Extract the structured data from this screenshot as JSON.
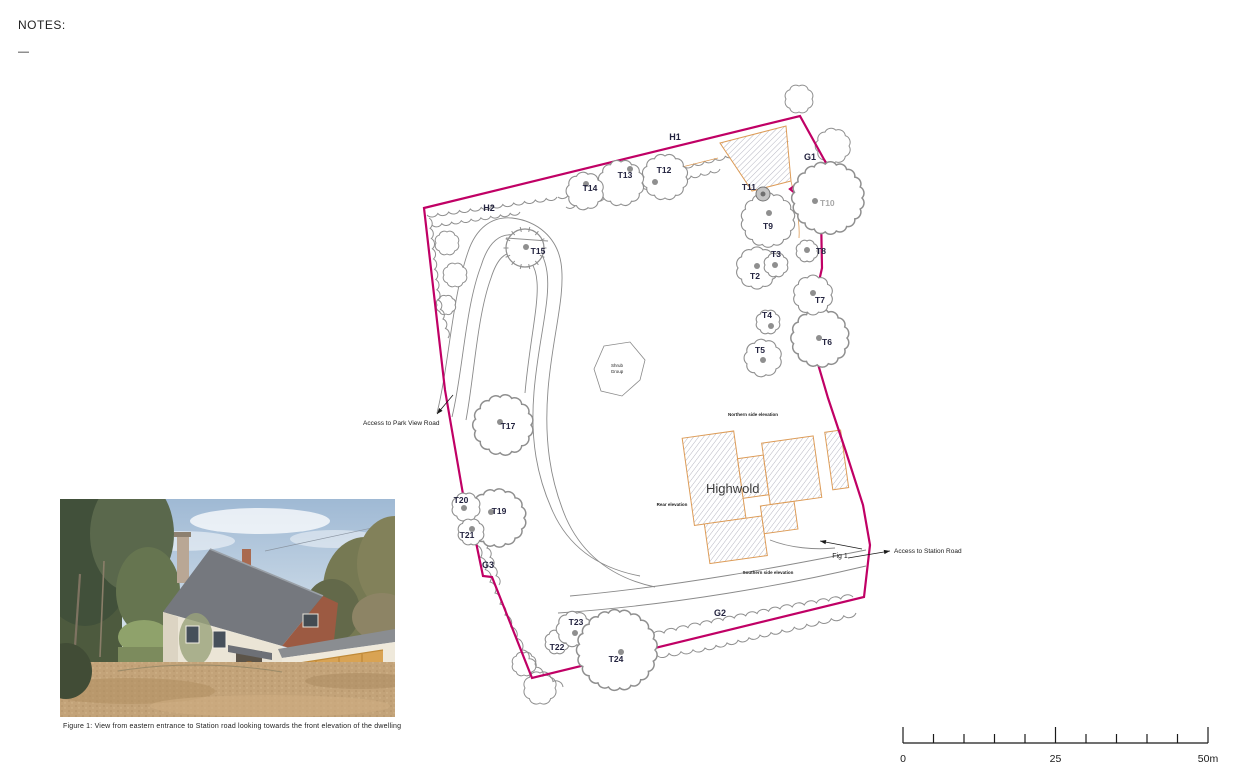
{
  "notes": {
    "title": "NOTES:",
    "dash": "—"
  },
  "figure": {
    "caption": "Figure 1: View from eastern entrance to Station road looking towards the front elevation of the dwelling"
  },
  "scale_bar": {
    "labels": [
      "0",
      "25",
      "50m"
    ],
    "divisions": 10,
    "units_per_division_m": 5
  },
  "colors": {
    "boundary": "#c00065",
    "canopy": "#8f8f8f",
    "dot": "#8f8f8f",
    "label": "#23233f",
    "muted_label": "#a8a8a8",
    "building_outline": "#dd9c58",
    "hatch_line": "#b6b6c2",
    "annotation": "#1a1a1a",
    "drive": "#8a8a8a"
  },
  "plan": {
    "building_name": "Highwold",
    "trees": [
      {
        "id": "T2",
        "cx": 757,
        "cy": 268,
        "r": 19,
        "dx": 757,
        "dy": 266,
        "lx": 755,
        "ly": 279
      },
      {
        "id": "T3",
        "cx": 776,
        "cy": 265,
        "r": 11,
        "dx": 775,
        "dy": 265,
        "lx": 776,
        "ly": 257
      },
      {
        "id": "T4",
        "cx": 768,
        "cy": 322,
        "r": 11,
        "dx": 771,
        "dy": 326,
        "lx": 767,
        "ly": 318
      },
      {
        "id": "T5",
        "cx": 763,
        "cy": 358,
        "r": 17,
        "dx": 763,
        "dy": 360,
        "lx": 760,
        "ly": 353
      },
      {
        "id": "T6",
        "cx": 820,
        "cy": 338,
        "r": 27,
        "dx": 819,
        "dy": 338,
        "lx": 827,
        "ly": 345
      },
      {
        "id": "T7",
        "cx": 813,
        "cy": 295,
        "r": 18,
        "dx": 813,
        "dy": 293,
        "lx": 820,
        "ly": 303
      },
      {
        "id": "T8",
        "cx": 807,
        "cy": 251,
        "r": 10,
        "dx": 807,
        "dy": 250,
        "lx": 816,
        "ly": 254,
        "anchor": "start"
      },
      {
        "id": "T9",
        "cx": 768,
        "cy": 220,
        "r": 25,
        "dx": 769,
        "dy": 213,
        "lx": 768,
        "ly": 229
      },
      {
        "id": "T10",
        "cx": 828,
        "cy": 198,
        "r": 34,
        "dx": 815,
        "dy": 201,
        "lx": 820,
        "ly": 206,
        "anchor": "start",
        "muted": true
      },
      {
        "id": "T11",
        "cx": 763,
        "cy": 194,
        "r": 7,
        "style": "marker",
        "dx": 763,
        "dy": 194,
        "lx": 756,
        "ly": 190,
        "anchor": "end"
      },
      {
        "id": "T12",
        "cx": 665,
        "cy": 177,
        "r": 21,
        "dx": 655,
        "dy": 182,
        "lx": 664,
        "ly": 173
      },
      {
        "id": "T13",
        "cx": 621,
        "cy": 183,
        "r": 21,
        "dx": 630,
        "dy": 169,
        "lx": 625,
        "ly": 178
      },
      {
        "id": "T14",
        "cx": 585,
        "cy": 191,
        "r": 17,
        "dx": 586,
        "dy": 184,
        "lx": 590,
        "ly": 191
      },
      {
        "id": "T15",
        "cx": 525,
        "cy": 248,
        "r": 19,
        "style": "tick",
        "dx": 526,
        "dy": 247,
        "lx": 538,
        "ly": 254
      },
      {
        "id": "T17",
        "cx": 503,
        "cy": 425,
        "r": 28,
        "dx": 500,
        "dy": 422,
        "lx": 508,
        "ly": 429
      },
      {
        "id": "T19",
        "cx": 497,
        "cy": 518,
        "r": 27,
        "dx": 491,
        "dy": 512,
        "lx": 499,
        "ly": 514
      },
      {
        "id": "T20",
        "cx": 466,
        "cy": 507,
        "r": 13,
        "dx": 464,
        "dy": 508,
        "lx": 461,
        "ly": 503
      },
      {
        "id": "T21",
        "cx": 471,
        "cy": 532,
        "r": 12,
        "dx": 472,
        "dy": 529,
        "lx": 467,
        "ly": 538
      },
      {
        "id": "T22",
        "cx": 557,
        "cy": 642,
        "r": 11,
        "dx": 565,
        "dy": 641,
        "lx": 557,
        "ly": 650
      },
      {
        "id": "T23",
        "cx": 574,
        "cy": 629,
        "r": 16,
        "dx": 575,
        "dy": 633,
        "lx": 576,
        "ly": 625
      },
      {
        "id": "T24",
        "cx": 617,
        "cy": 650,
        "r": 38,
        "dx": 621,
        "dy": 652,
        "lx": 616,
        "ly": 662
      }
    ],
    "area_labels": [
      {
        "id": "H1",
        "x": 675,
        "y": 140
      },
      {
        "id": "H2",
        "x": 489,
        "y": 211
      },
      {
        "id": "G1",
        "x": 810,
        "y": 160
      },
      {
        "id": "G2",
        "x": 720,
        "y": 616
      },
      {
        "id": "G3",
        "x": 488,
        "y": 568
      }
    ],
    "shrub_label": [
      "Shrub",
      "Group"
    ],
    "annotations": {
      "access_park": {
        "text": "Access to Park View Road",
        "x": 363,
        "y": 425,
        "anchor": "start"
      },
      "access_station": {
        "text": "Access to Station Road",
        "x": 894,
        "y": 553,
        "anchor": "start"
      },
      "fig1": {
        "text": "Fig 1",
        "x": 840,
        "y": 558,
        "anchor": "middle"
      },
      "north_elev": {
        "text": "Northern side elevation",
        "x": 753,
        "y": 416
      },
      "rear_elev": {
        "text": "Rear elevation",
        "x": 672,
        "y": 506
      },
      "south_elev": {
        "text": "Southern side elevation",
        "x": 768,
        "y": 574
      },
      "highwold": {
        "x": 706,
        "y": 493
      }
    }
  }
}
